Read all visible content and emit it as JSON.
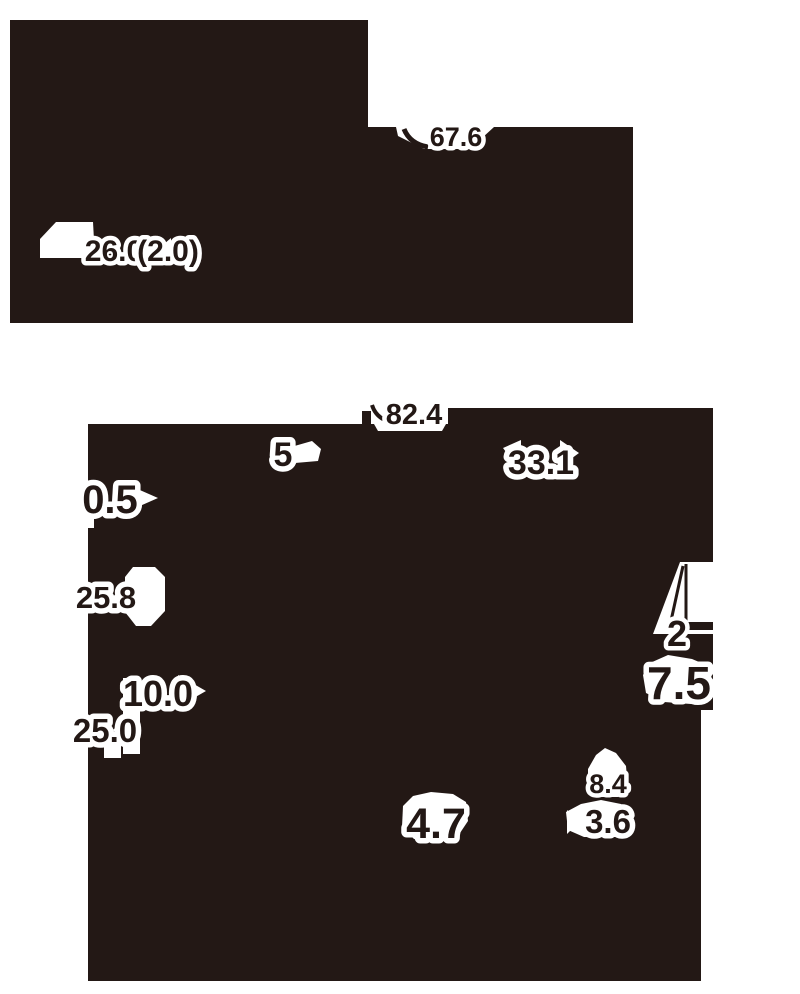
{
  "figure": {
    "description": "Monochrome infographic with two upper dark panels and one large lower dark panel, annotated with numeric value callouts",
    "colors": {
      "ink": "#231815",
      "halo": "#ffffff",
      "paper": "#ffffff"
    }
  },
  "panels": {
    "top_left": {
      "label_value": "26.0",
      "label_value_secondary": "(2.0)"
    },
    "top_right": {
      "label_value": "67.6"
    },
    "bottom": {
      "top_label": "82.4",
      "values": {
        "v5": "5",
        "v331": "33.1",
        "v05": "0.5",
        "v258": "25.8",
        "v100": "10.0",
        "v250": "25.0",
        "v2": "2",
        "v75": "7.5",
        "v84": "8.4",
        "v47": "4.7",
        "v36": "3.6"
      }
    }
  },
  "labels": {
    "l676": {
      "value": "67.6"
    },
    "l260": {
      "value": "26.0"
    },
    "l20": {
      "value": "(2.0)"
    },
    "l824": {
      "value": "82.4"
    },
    "l5": {
      "value": "5"
    },
    "l331": {
      "value": "33.1"
    },
    "l05": {
      "value": "0.5"
    },
    "l258": {
      "value": "25.8"
    },
    "l100": {
      "value": "10.0"
    },
    "l250": {
      "value": "25.0"
    },
    "l2": {
      "value": "2"
    },
    "l75": {
      "value": "7.5"
    },
    "l84": {
      "value": "8.4"
    },
    "l36": {
      "value": "3.6"
    },
    "l47": {
      "value": "4.7"
    }
  }
}
